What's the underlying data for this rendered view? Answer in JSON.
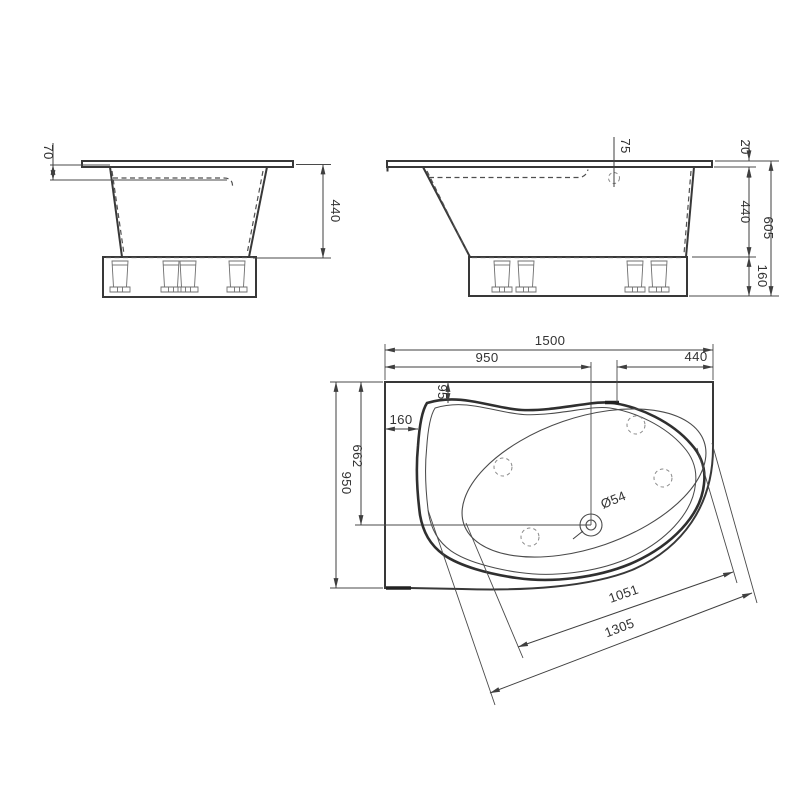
{
  "colors": {
    "background": "#ffffff",
    "line": "#3a3a3a"
  },
  "side_view": {
    "dims": {
      "rim_to_waterline": "70",
      "tub_depth": "440"
    }
  },
  "front_view": {
    "dims": {
      "overflow_offset": "75",
      "rim_edge": "20",
      "tub_depth": "440",
      "overall_height": "605",
      "plinth_height": "160"
    }
  },
  "plan_view": {
    "dims": {
      "overall_length": "1500",
      "drain_from_left": "950",
      "overflow_to_right": "440",
      "rim_setback_top": "95",
      "rim_setback_left": "160",
      "drain_from_top": "662",
      "overall_width": "950",
      "drain_diameter": "Ø54",
      "basin_diagonal": "1051",
      "rim_diagonal": "1305"
    }
  }
}
